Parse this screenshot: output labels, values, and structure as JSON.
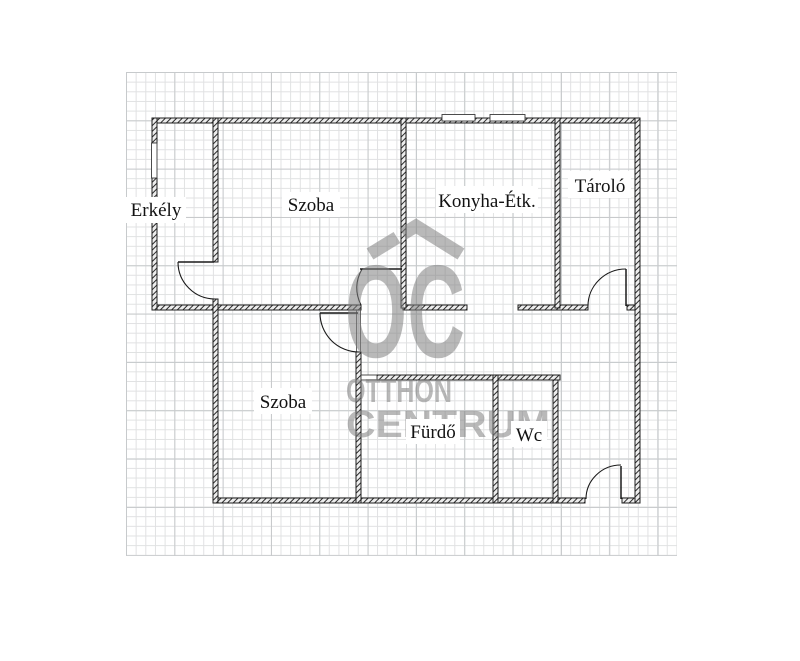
{
  "rooms": [
    {
      "id": "erkely",
      "label": "Erkély"
    },
    {
      "id": "szoba-top",
      "label": "Szoba"
    },
    {
      "id": "konyha-etk",
      "label": "Konyha-Étk."
    },
    {
      "id": "tarolo",
      "label": "Tároló"
    },
    {
      "id": "szoba-bottom",
      "label": "Szoba"
    },
    {
      "id": "furdo",
      "label": "Fürdő"
    },
    {
      "id": "wc",
      "label": "Wc"
    }
  ],
  "watermark": {
    "monogram": "OC",
    "line1": "OTTHON",
    "line2": "CENTRUM"
  },
  "colors": {
    "wall_line": "#1f1f1f",
    "grid_minor": "#e0e1e2",
    "grid_major": "#c7cacc",
    "watermark_gray": "#808080",
    "label_text": "#121212",
    "background": "#ffffff"
  }
}
